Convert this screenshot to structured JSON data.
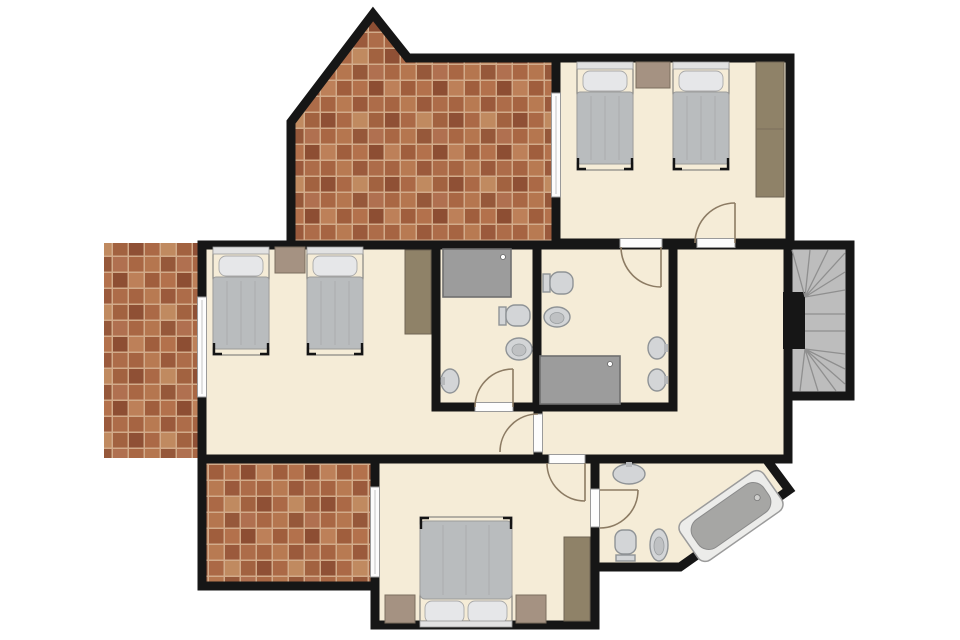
{
  "scene": {
    "type": "floor-plan",
    "view": "top-down architectural plan, no text labels",
    "rooms": [
      {
        "name": "bedroom-top-right",
        "furniture": [
          "single-bed",
          "single-bed",
          "nightstand",
          "wardrobe"
        ],
        "openings": [
          "window-to-top-terrace",
          "door-to-hall",
          "door-to-ensuite-bathroom"
        ]
      },
      {
        "name": "bedroom-left",
        "furniture": [
          "single-bed",
          "single-bed",
          "nightstand",
          "wardrobe"
        ],
        "openings": [
          "window-to-left-terrace"
        ]
      },
      {
        "name": "bathroom-center-left",
        "fixtures": [
          "shower-tray",
          "toilet",
          "bidet",
          "sink"
        ],
        "openings": [
          "door-to-corridor"
        ]
      },
      {
        "name": "bathroom-center-right",
        "fixtures": [
          "toilet",
          "bidet",
          "shower-tray",
          "sink",
          "sink"
        ],
        "openings": [
          "door-to-bedroom-top-right"
        ]
      },
      {
        "name": "bedroom-bottom",
        "furniture": [
          "double-bed",
          "nightstand",
          "nightstand",
          "wardrobe"
        ],
        "openings": [
          "sliding-door-to-bottom-terrace",
          "door-to-corridor",
          "door-to-ensuite-bathroom"
        ]
      },
      {
        "name": "bathroom-bottom-right",
        "fixtures": [
          "sink",
          "toilet",
          "bidet",
          "bathtub-angled"
        ],
        "shape": "chamfered-corner"
      },
      {
        "name": "hall-corridor",
        "features": [
          "winder-staircase"
        ]
      },
      {
        "name": "terrace-top",
        "surface": "brick-tile",
        "shape": "gabled-point"
      },
      {
        "name": "terrace-left",
        "surface": "brick-tile"
      },
      {
        "name": "terrace-bottom",
        "surface": "brick-tile"
      }
    ],
    "counts": {
      "doors_with_swing_arcs": 6,
      "window_strips": 3,
      "beds": 5,
      "toilets": 3,
      "bidets": 3,
      "sinks": 4,
      "showers": 2,
      "bathtubs": 1,
      "wardrobes": 3,
      "nightstands": 4
    }
  },
  "colors": {
    "outside": "#ffffff",
    "floor": "#f5ecd7",
    "wall": "#161616",
    "brick_grout": "#d2ab8a",
    "stair_fill": "#bdbdbd",
    "stair_line": "#8f8f8f",
    "fixture_fill": "#d3d5d7",
    "shower_fill": "#9c9c9c",
    "wood_wardrobe": "#8f8268",
    "wood_nightstand": "#a59282",
    "bed_blanket": "#b9bcbe",
    "bed_pillow": "#e6e7e9",
    "tub_outer": "#ececea",
    "tub_inner": "#a6a6a4",
    "door_arc": "#8c7b63"
  }
}
